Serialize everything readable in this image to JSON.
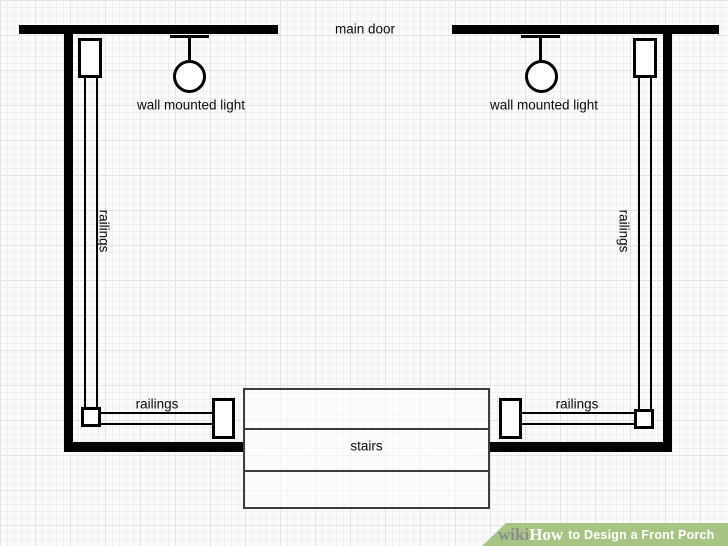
{
  "diagram": {
    "type": "front-porch-floor-plan",
    "labels": {
      "main_door": "main door",
      "wall_mounted_light": "wall mounted light",
      "railings": "railings",
      "stairs": "stairs"
    }
  },
  "watermark": {
    "brand_prefix": "wiki",
    "brand_suffix": "How",
    "title": "to Design a Front Porch"
  },
  "colors": {
    "wall": "#000000",
    "stairs_outline": "#3d3d3d",
    "banner_green": "#a8c485",
    "brand_gray": "#8c8c8c",
    "banner_text": "#ffffff",
    "grid_line_minor": "#efeff3",
    "grid_line_major": "#e3e3ea",
    "background": "#fbfbfc"
  }
}
